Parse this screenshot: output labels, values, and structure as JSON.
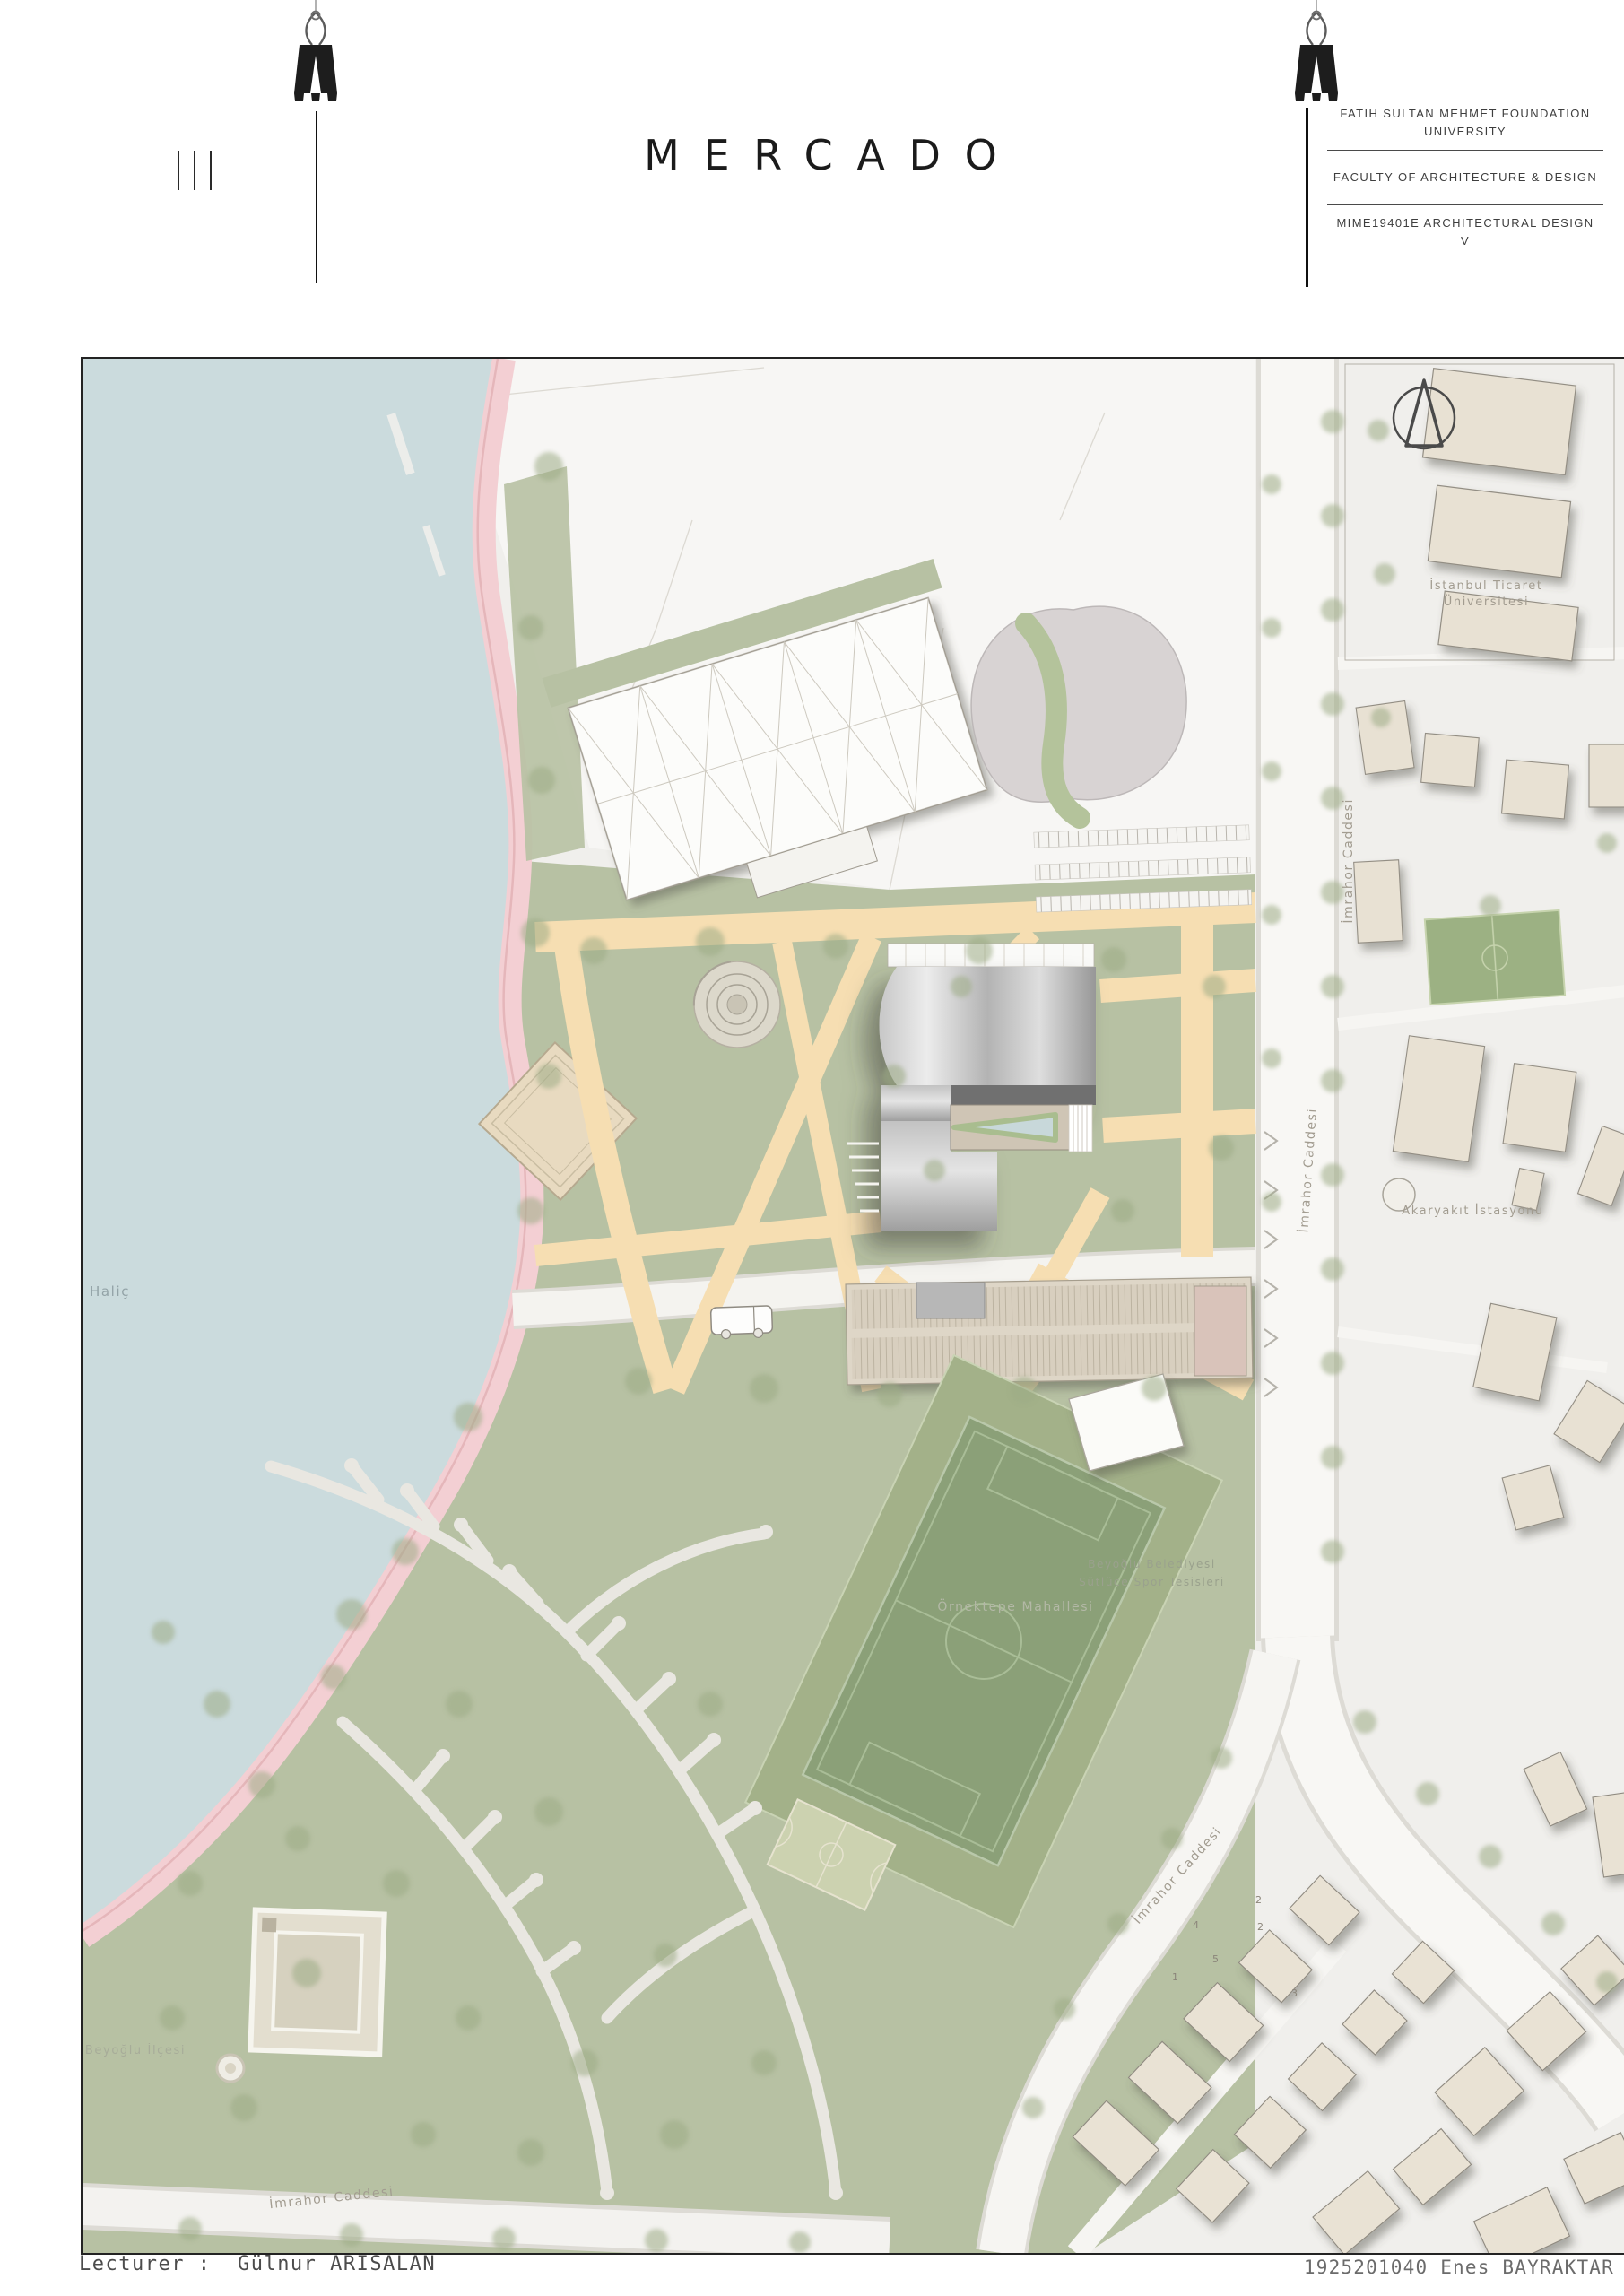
{
  "header": {
    "title": "MERCADO",
    "org": "FATIH SULTAN MEHMET FOUNDATION UNIVERSITY",
    "faculty": "FACULTY OF ARCHITECTURE & DESIGN",
    "course": "MIME19401E ARCHITECTURAL DESIGN V"
  },
  "footer": {
    "lecturer_label": "Lecturer :",
    "lecturer_name": "Gülnur ARISALAN",
    "student_id": "1925201040",
    "student_name": "Enes BAYRAKTAR"
  },
  "map": {
    "labels": {
      "water": "Haliç",
      "university": "İstanbul Ticaret Üniversitesi",
      "street_imrahor_1": "İmrahor Caddesi",
      "street_imrahor_2": "İmrahor Caddesi",
      "street_imrahor_3": "İmrahor Caddesi",
      "street_imrahor_4": "İmrahor Caddesi",
      "gas_station": "Akaryakıt İstasyonu",
      "neighborhood": "Örnektepe Mahallesi",
      "sports_facility_line1": "Beyoğlu Belediyesi",
      "sports_facility_line2": "Sütlüce Spor Tesisleri",
      "district": "Beyoğlu İlçesi"
    },
    "building_numbers": [
      "4",
      "5",
      "1",
      "2",
      "2",
      "3"
    ],
    "colors": {
      "water": "#cbdbdd",
      "shore_path": "#f3cfd3",
      "park_green": "#b7c1a3",
      "field_green": "#8ba078",
      "plaza_tan": "#f6deb2",
      "building_beige": "#e8e1d3",
      "roof_metal": "#b9b9b9"
    }
  }
}
